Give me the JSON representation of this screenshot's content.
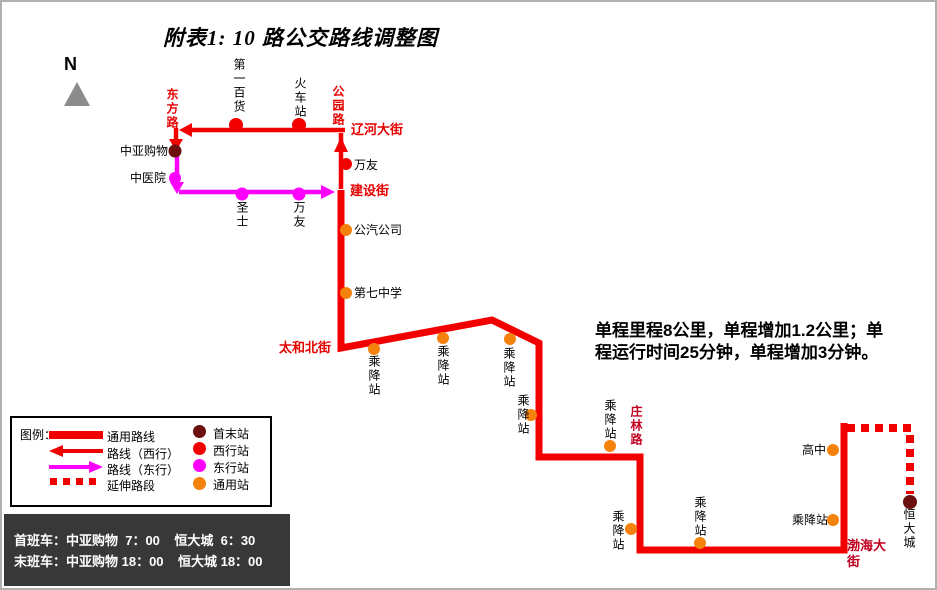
{
  "title": "附表1: 10 路公交路线调整图",
  "compass_label": "N",
  "note": {
    "line1": "单程里程8公里，单程增加1.2公里；单",
    "line2": "程运行时间25分钟，单程增加3分钟。"
  },
  "streets": {
    "dongfang": "东方路",
    "gongyuan": "公园路",
    "liaohe": "辽河大街",
    "jianshe": "建设街",
    "taihebei": "太和北街",
    "zhuanglin": "庄林路",
    "bohai": "渤海大街"
  },
  "stations": {
    "zhongya_shopping": "中亚购物",
    "zhongyi_hospital": "中医院",
    "first_department_store": "第一百货",
    "railway_station": "火车站",
    "wanyou": "万友",
    "shengshi": "圣士",
    "bus_company": "公汽公司",
    "no7_middle_school": "第七中学",
    "stop": "乘降站",
    "high_school": "高中",
    "hengda_city": "恒大城"
  },
  "legend": {
    "title": "图例：",
    "routes": [
      {
        "label": "通用路线"
      },
      {
        "label": "路线（西行）"
      },
      {
        "label": "路线（东行）"
      },
      {
        "label": "延伸路段"
      }
    ],
    "station_types": [
      {
        "label": "首末站",
        "color": "#6b0f0f"
      },
      {
        "label": "西行站",
        "color": "#f20000"
      },
      {
        "label": "东行站",
        "color": "#ff00ff"
      },
      {
        "label": "通用站",
        "color": "#f5820d"
      }
    ]
  },
  "schedule": {
    "row1": "首班车：中亚购物  7：00    恒大城  6：30",
    "row2": "末班车：中亚购物 18：00    恒大城 18：00"
  },
  "palette": {
    "route_red": "#f20000",
    "eastbound_magenta": "#ff00ff",
    "common_orange": "#f5820d",
    "terminal_maroon": "#6b0f0f",
    "street_red": "#e60000",
    "street_dark_red": "#c00020",
    "schedule_bg": "#383838"
  }
}
